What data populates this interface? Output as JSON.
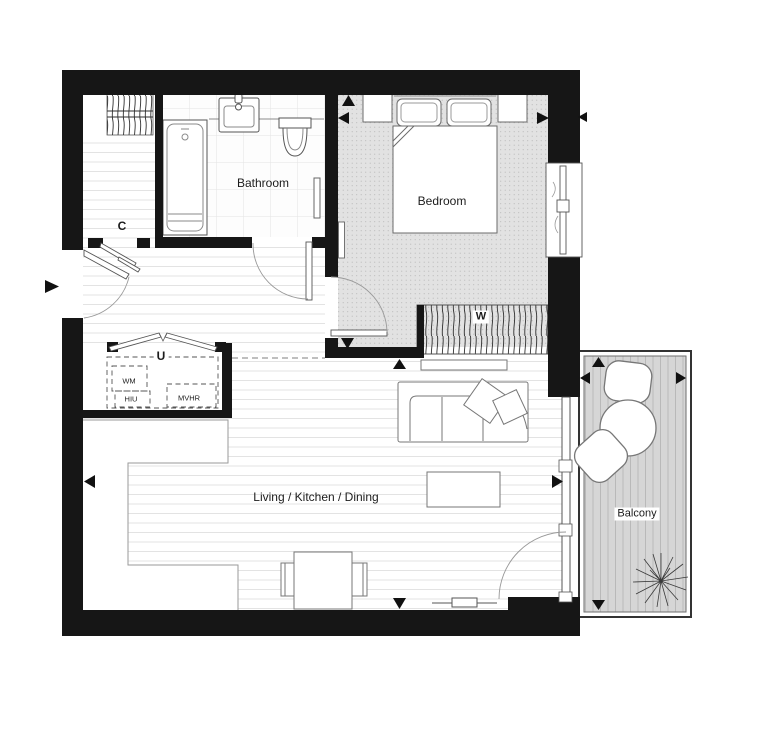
{
  "document": {
    "type": "apartment-floor-plan"
  },
  "rooms": {
    "bathroom": {
      "label": "Bathroom"
    },
    "bedroom": {
      "label": "Bedroom"
    },
    "living_kitchen_dining": {
      "label": "Living / Kitchen / Dining"
    },
    "balcony": {
      "label": "Balcony"
    },
    "closet": {
      "label": "C"
    },
    "utility_cupboard": {
      "label": "U"
    }
  },
  "equipment": {
    "washing_machine": {
      "label": "WM"
    },
    "heat_interface_unit": {
      "label": "HIU"
    },
    "ventilation_unit": {
      "label": "MVHR"
    },
    "wardrobe": {
      "label": "W"
    }
  },
  "colors": {
    "wall": "#161616",
    "carpet": "#e2e2e2",
    "decking": "#d6d6d6",
    "furniture_line": "#777777",
    "dash_line": "#999999"
  }
}
